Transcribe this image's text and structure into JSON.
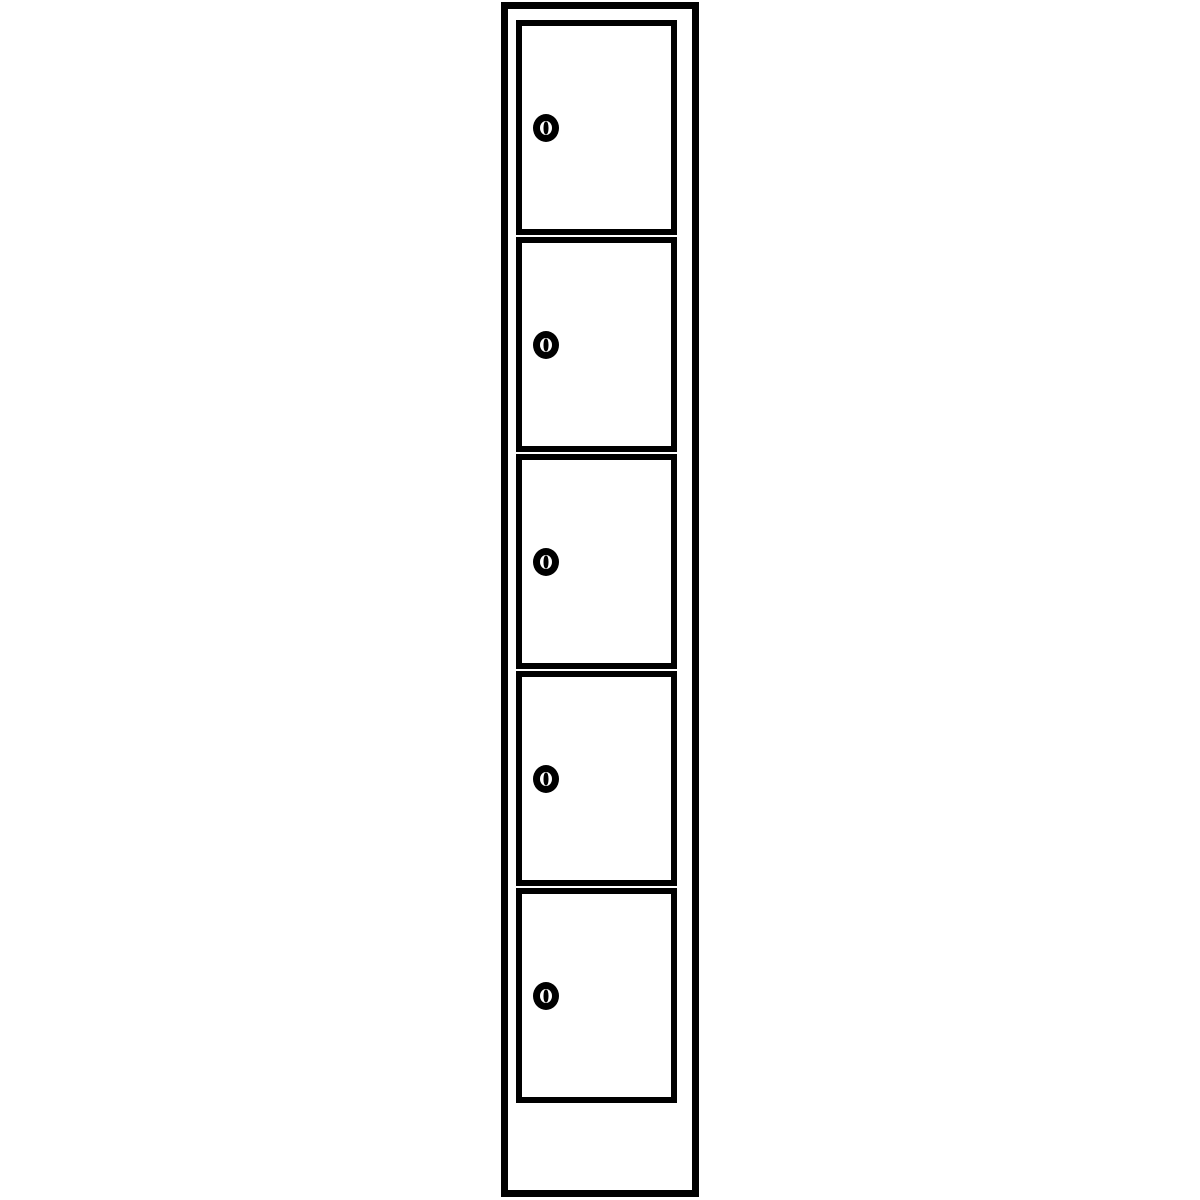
{
  "figure": {
    "type": "line-drawing",
    "subject": "single-column locker cabinet with five lockable compartments and plinth base",
    "stroke_color": "#000000",
    "background_color": "#ffffff",
    "compartment_count": 5,
    "compartments": [
      {
        "id": 1,
        "lock_icon": "cylinder-lock-icon"
      },
      {
        "id": 2,
        "lock_icon": "cylinder-lock-icon"
      },
      {
        "id": 3,
        "lock_icon": "cylinder-lock-icon"
      },
      {
        "id": 4,
        "lock_icon": "cylinder-lock-icon"
      },
      {
        "id": 5,
        "lock_icon": "cylinder-lock-icon"
      }
    ]
  }
}
